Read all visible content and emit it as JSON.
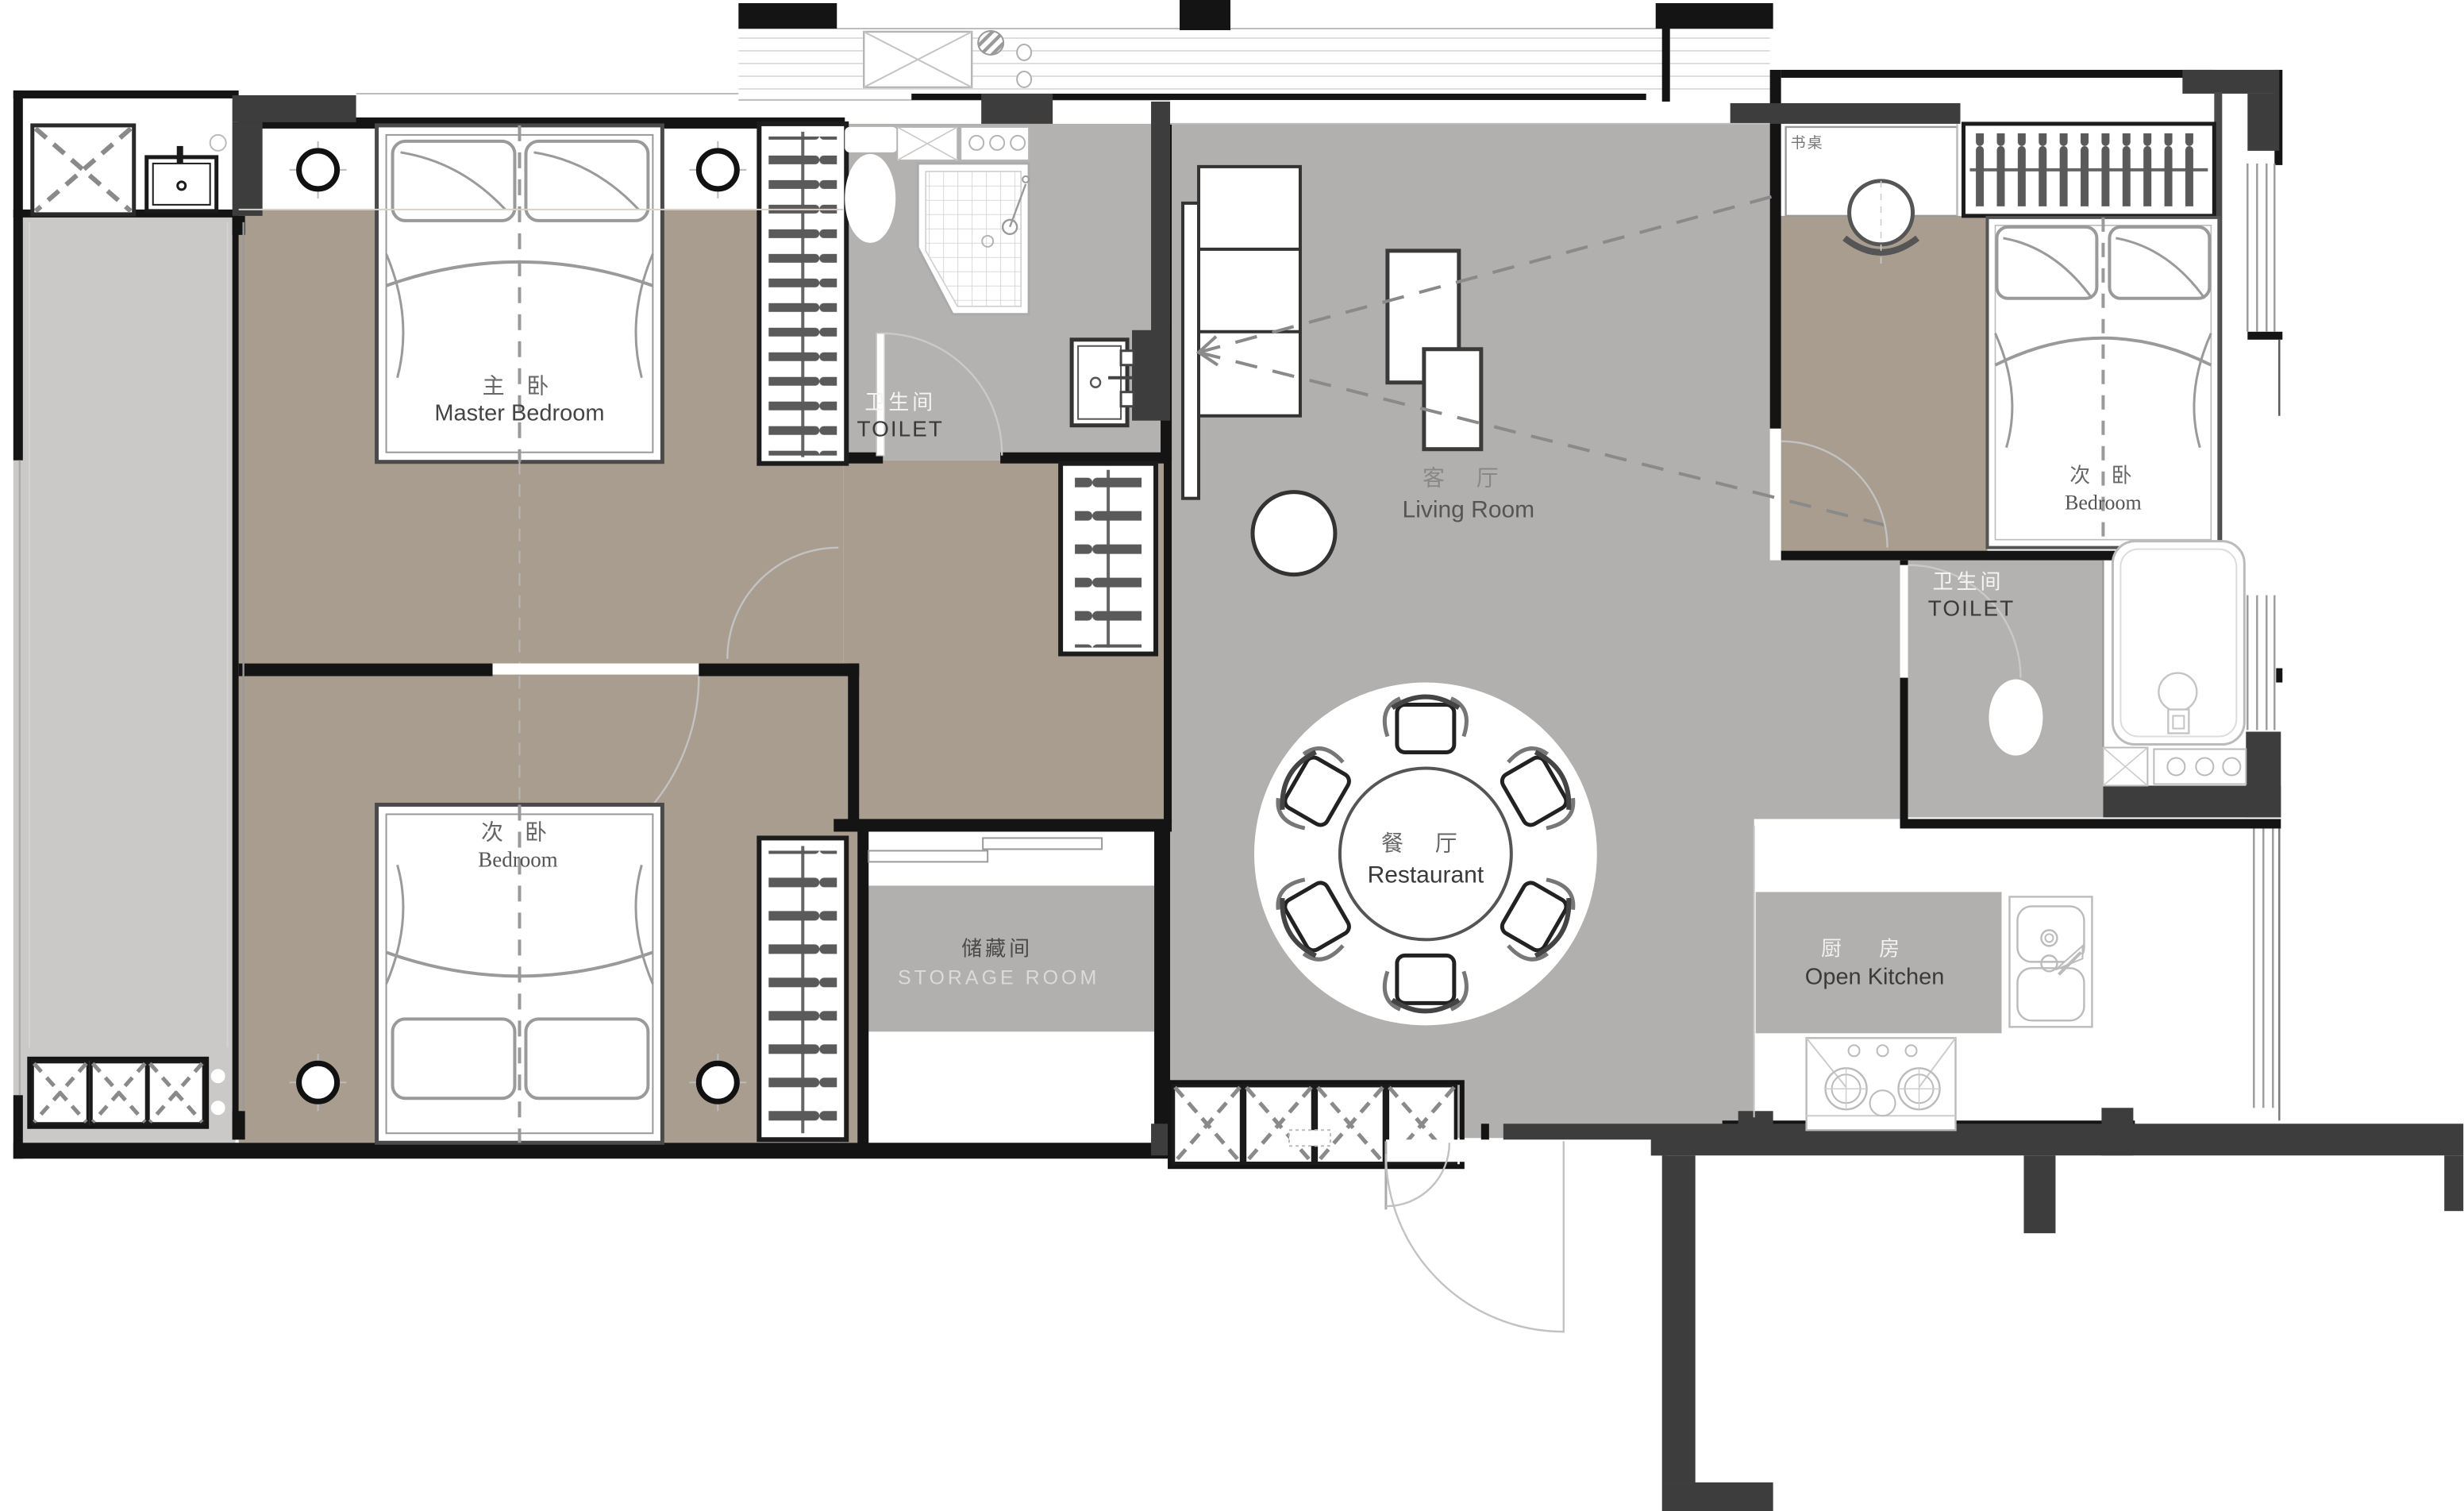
{
  "document": {
    "type": "apartment-floor-plan"
  },
  "palette": {
    "floor_warm": "#a99d90",
    "floor_gray": "#b4b2b0",
    "floor_light": "#cbc9c7",
    "wall_black": "#141414",
    "wall_darkgray": "#3d3d3d",
    "furniture_line": "#555555",
    "label_gray": "#666666",
    "label_dark": "#3a3a3a",
    "label_ghost": "#f5f4f2"
  },
  "rooms": {
    "master": {
      "zh": "主 卧",
      "en": "Master Bedroom"
    },
    "toilet1": {
      "zh": "卫生间",
      "en": "TOILET"
    },
    "living": {
      "zh": "客 厅",
      "en": "Living Room"
    },
    "dining": {
      "zh": "餐 厅",
      "en": "Restaurant"
    },
    "bedroom2": {
      "zh": "次 卧",
      "en": "Bedroom"
    },
    "bedroom3": {
      "zh": "次 卧",
      "en": "Bedroom"
    },
    "toilet2": {
      "zh": "卫生间",
      "en": "TOILET"
    },
    "storage": {
      "zh": "储藏间",
      "en": "STORAGE ROOM"
    },
    "kitchen": {
      "zh": "厨 房",
      "en": "Open Kitchen"
    },
    "desk": {
      "zh": "书桌"
    }
  },
  "furniture": [
    "double-bed",
    "wardrobe-hangers",
    "ceiling-lamp",
    "toilet-bowl",
    "shower-cabin",
    "wash-basin",
    "sofa",
    "coffee-table",
    "round-dining-table",
    "dining-chair",
    "shoe-cabinet",
    "storage-cabinet",
    "bathtub",
    "kitchen-sink",
    "gas-stove",
    "desk",
    "desk-chair",
    "washing-machine",
    "entry-door",
    "side-table"
  ]
}
